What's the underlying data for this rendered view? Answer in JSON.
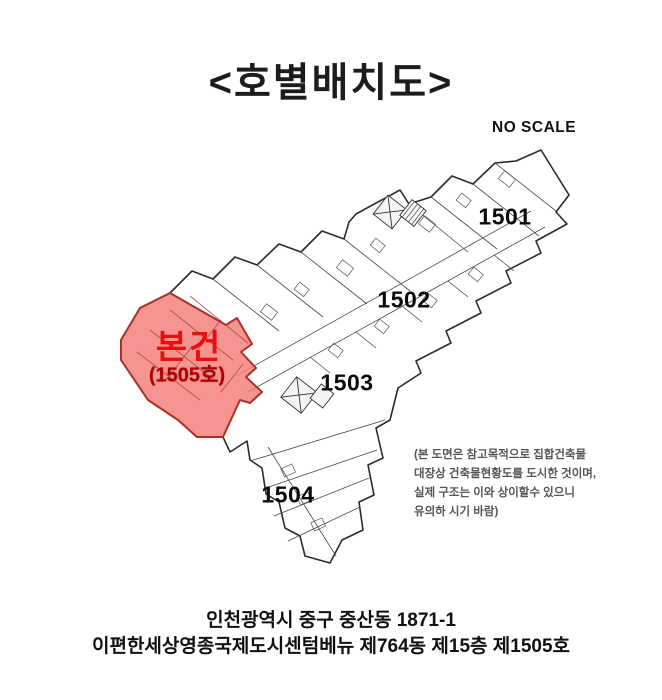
{
  "title": "<호별배치도>",
  "scale_label": "NO SCALE",
  "plan": {
    "units": [
      {
        "label": "1501"
      },
      {
        "label": "1502"
      },
      {
        "label": "1503"
      },
      {
        "label": "1504"
      }
    ],
    "subject_unit": {
      "label": "본건",
      "number": "(1505호)"
    },
    "disclaimer": {
      "line1": "(본 도면은 참고목적으로 집합건축물",
      "line2": "대장상 건축물현황도를 도시한 것이며,",
      "line3": "실제 구조는 이와 상이할수 있으니",
      "line4": "유의하 시기 바람)"
    }
  },
  "footer": {
    "address_line1": "인천광역시 중구 중산동 1871-1",
    "address_line2": "이편한세상영종국제도시센텀베뉴  제764동 제15층 제1505호"
  },
  "colors": {
    "highlight_fill": "#f4817e",
    "highlight_border": "#a93226",
    "subject_text": "#e8100c",
    "subject_number_text": "#b00000",
    "plan_line": "#2b2b2b"
  }
}
